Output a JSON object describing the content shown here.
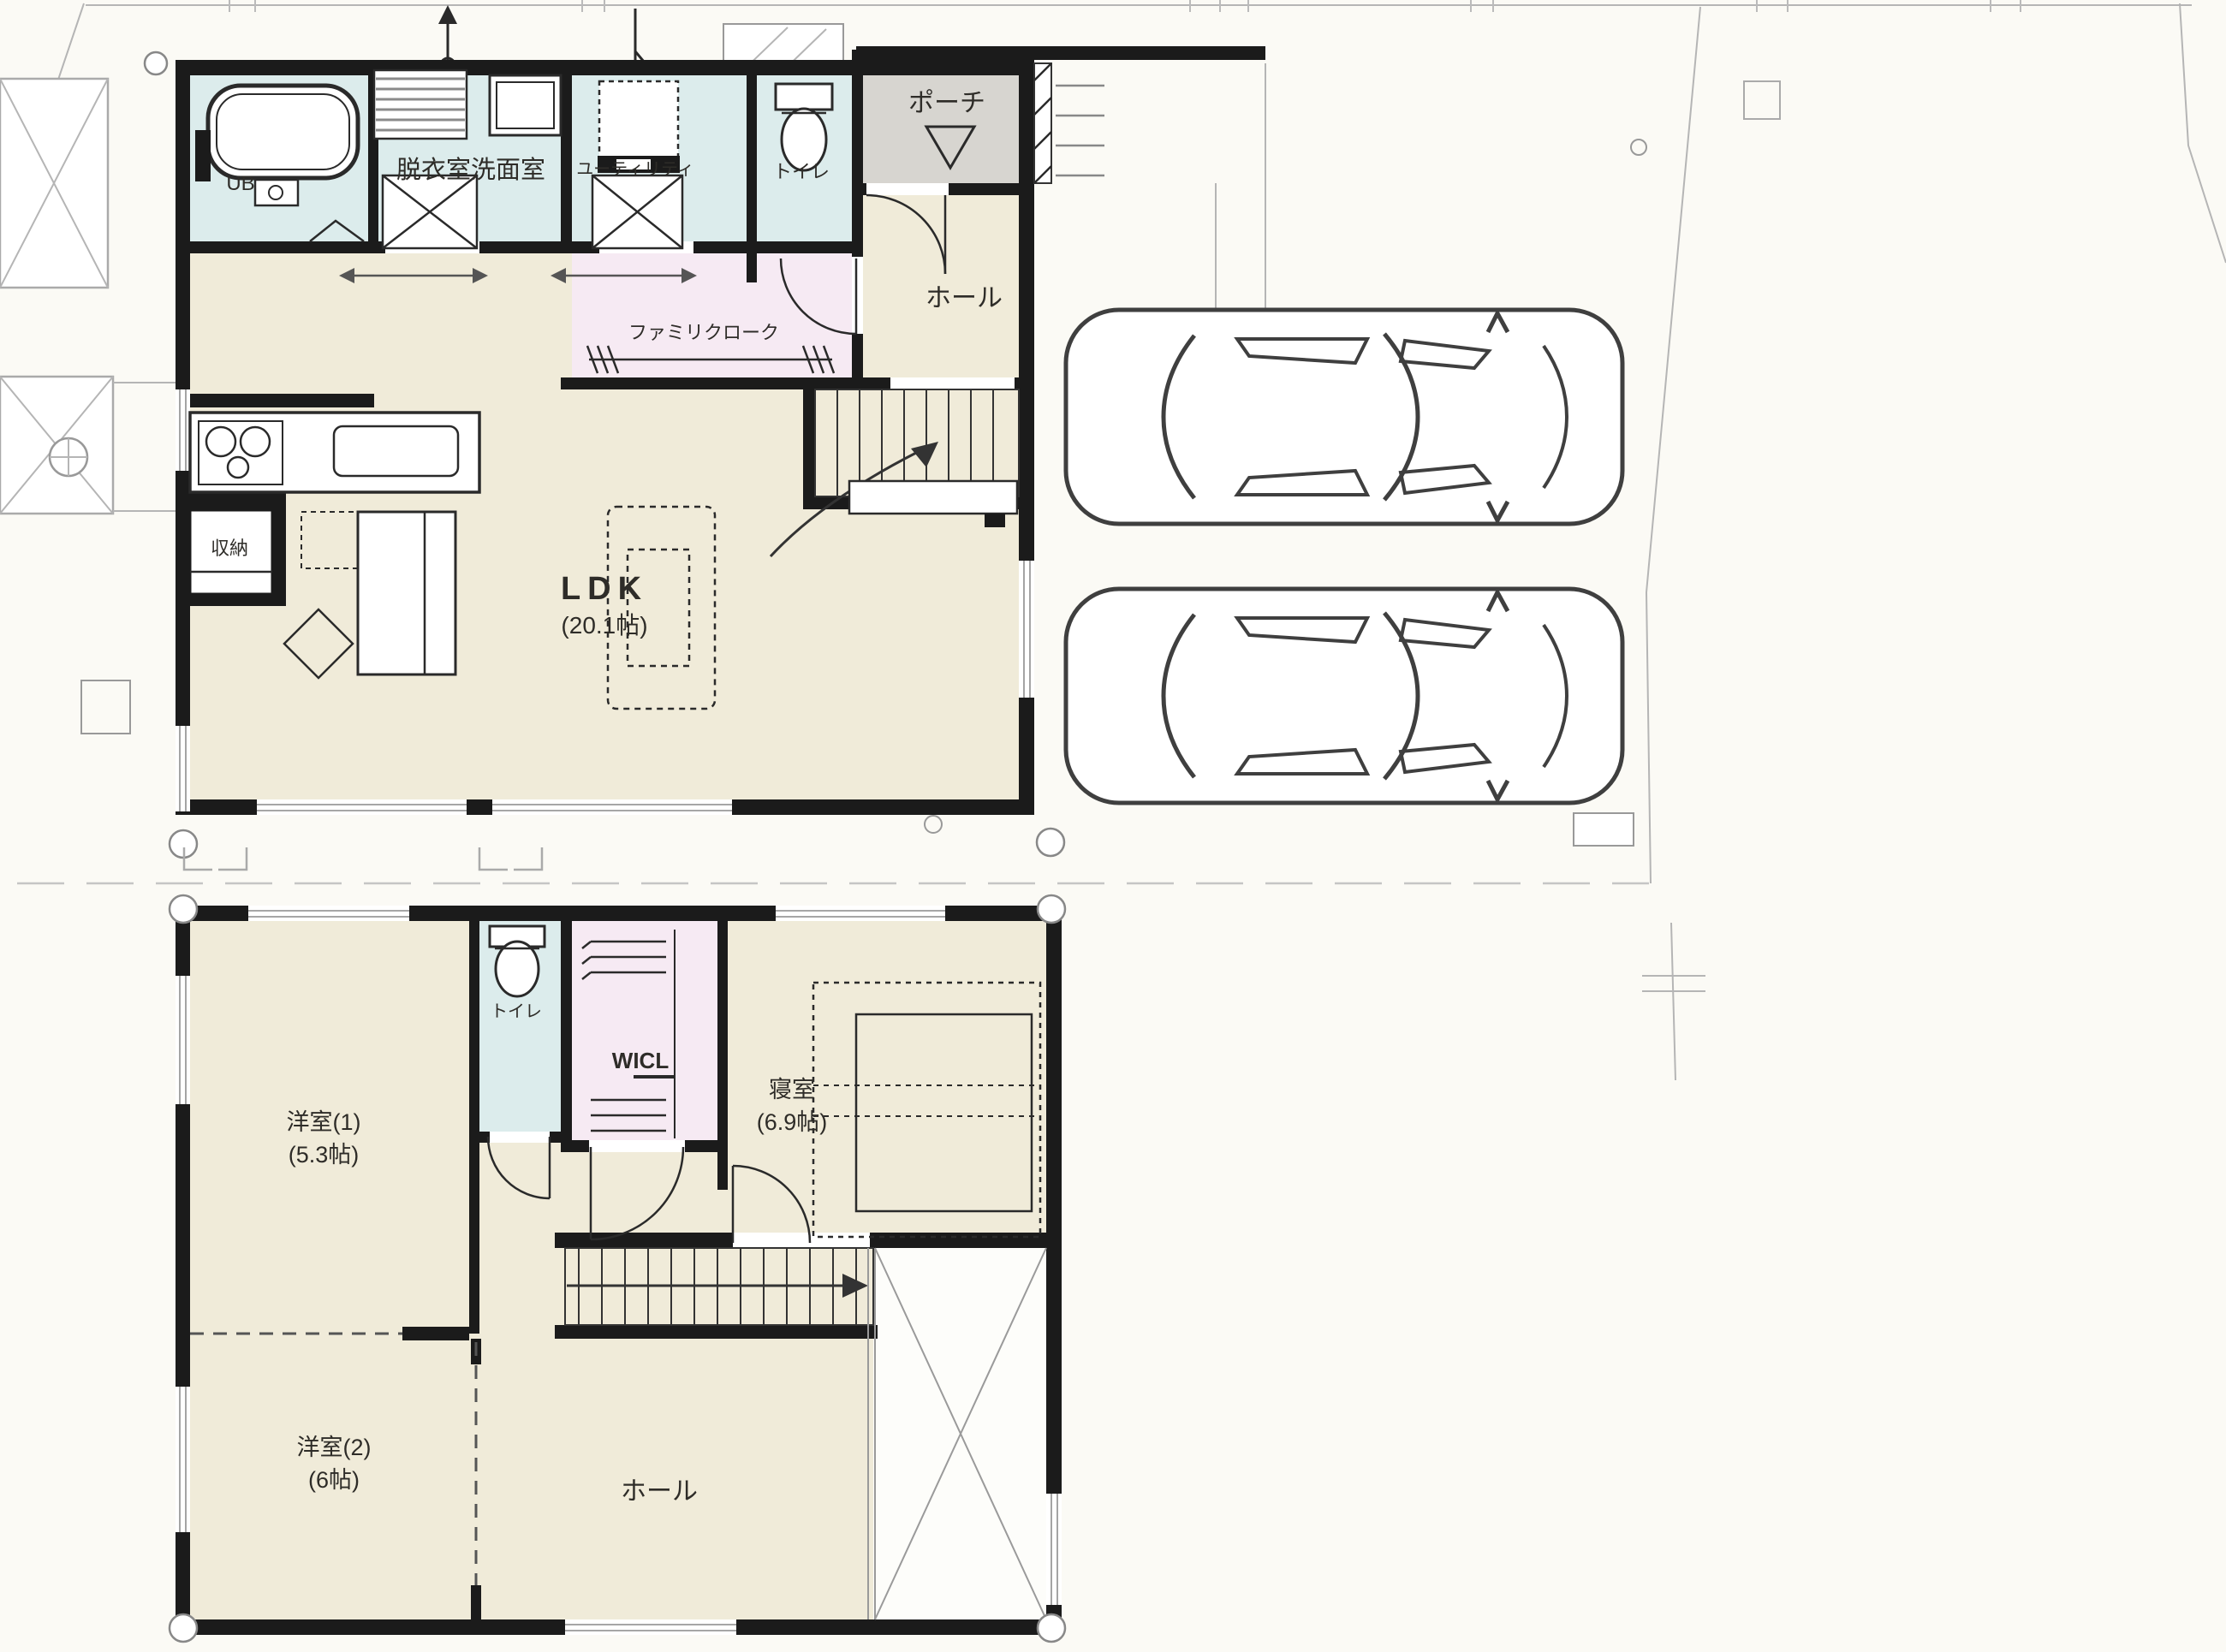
{
  "plan_title": "2-story house floor plan",
  "floor1": {
    "bath_label": "UB",
    "washroom_label": "脱衣室洗面室",
    "utility_label": "ユーティリティ",
    "toilet_label": "トイレ",
    "porch_label": "ポーチ",
    "hall_label": "ホール",
    "family_closet_label": "ファミリクローク",
    "ldk_label": "LDK",
    "ldk_size": "(20.1帖)",
    "storage_label": "収納"
  },
  "floor2": {
    "western1_label": "洋室(1)",
    "western1_size": "(5.3帖)",
    "toilet_label": "トイレ",
    "wicl_label": "WICL",
    "bedroom_label": "寝室",
    "bedroom_size": "(6.9帖)",
    "western2_label": "洋室(2)",
    "western2_size": "(6帖)",
    "hall_label": "ホール"
  },
  "colors": {
    "wall_black": "#1b1b1b",
    "floor_beige": "#f0ebd9",
    "wet_room_blue": "#dcecec",
    "closet_pink": "#f6eaf3",
    "porch_gray": "#d7d5d0",
    "site_line_gray": "#b5b5b5",
    "car_outline": "#3f3f3f"
  }
}
